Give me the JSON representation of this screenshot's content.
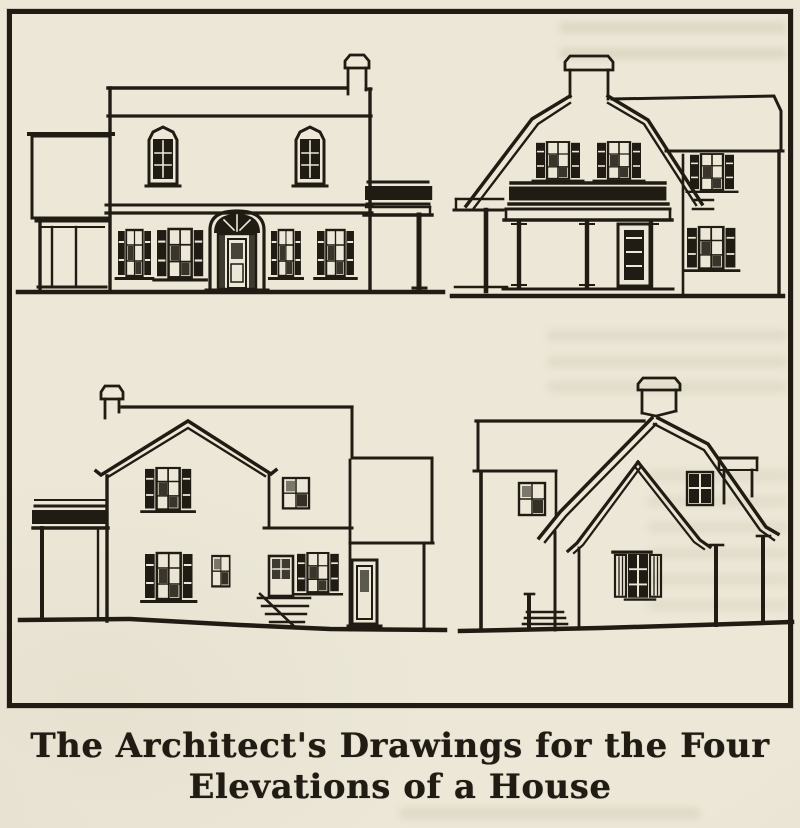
{
  "caption": {
    "line1": "The Architect's Drawings for the Four",
    "line2": "Elevations of a House"
  },
  "figure": {
    "panel_count": 4,
    "panels": [
      {
        "position": "top-left",
        "content": "front elevation, flat-parapet colonial facade with arched doorway, shuttered windows, side sun porch and pergola"
      },
      {
        "position": "top-right",
        "content": "end elevation, gambrel roof with chimney at ridge, balustraded porch with columns, rear wing"
      },
      {
        "position": "bottom-left",
        "content": "side elevation, gable end with chimney, sleeping-porch balcony, rear service wing with entry steps"
      },
      {
        "position": "bottom-right",
        "content": "rear elevation, large sweeping gable with flared eaves, projecting gabled bay and corner posts"
      }
    ]
  },
  "colors": {
    "paper": "#ece7d7",
    "ink": "#201c13",
    "smudge": "#8d835a"
  }
}
